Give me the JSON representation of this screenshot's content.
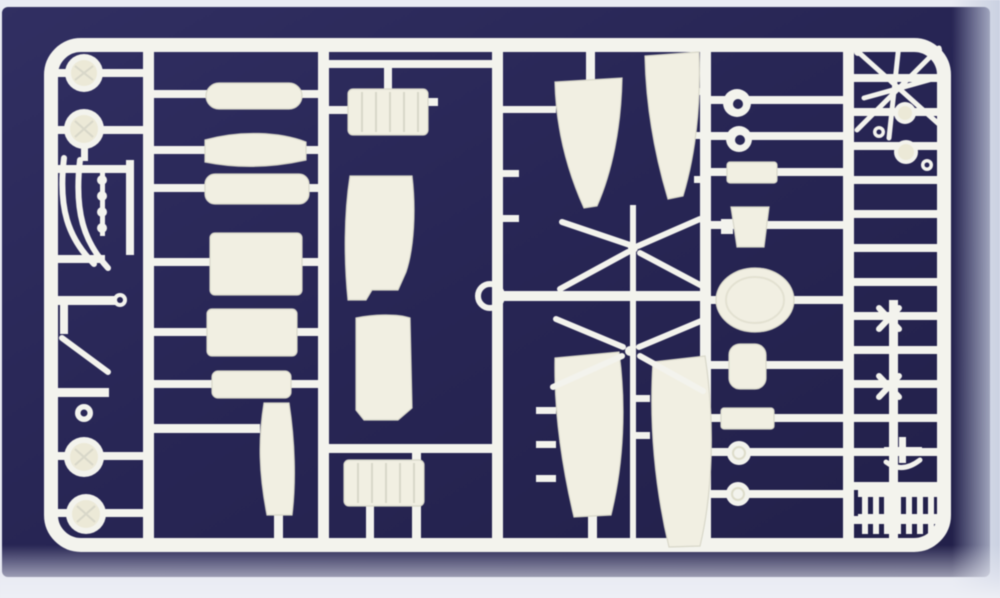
{
  "scene": {
    "description": "Photograph of an injection-molded model aircraft kit sprue: white and cream plastic parts attached to runners, shot against a dark navy background",
    "object": "model-kit-sprue"
  },
  "palette": {
    "bg-navy": "#282657",
    "bg-navy-deep": "#211f4a",
    "bg-navy-light": "#323066",
    "edge-light": "#e9ebf3",
    "edge-blue": "#c3cade",
    "plastic": "#f3f3ed",
    "plastic-shadow": "#d8d7c8",
    "plastic-cream": "#ece9d6",
    "plastic-cream-light": "#f1efe2"
  },
  "parts_inventory": [
    {
      "name": "main-wheel",
      "count": 4
    },
    {
      "name": "small-wheel",
      "count": 2
    },
    {
      "name": "fuselage-half",
      "count": 6
    },
    {
      "name": "engine-cowling-cylinder",
      "count": 2
    },
    {
      "name": "wing-panel",
      "count": 4
    },
    {
      "name": "float-section",
      "count": 2
    },
    {
      "name": "fin-rudder",
      "count": 1
    },
    {
      "name": "cabane-strut-assembly",
      "count": 2
    },
    {
      "name": "cowl-front-oval",
      "count": 1
    },
    {
      "name": "detail-ring",
      "count": 4
    },
    {
      "name": "detail-knob",
      "count": 2
    },
    {
      "name": "detail-tube",
      "count": 2
    },
    {
      "name": "rigging-strut",
      "count": 6
    }
  ]
}
